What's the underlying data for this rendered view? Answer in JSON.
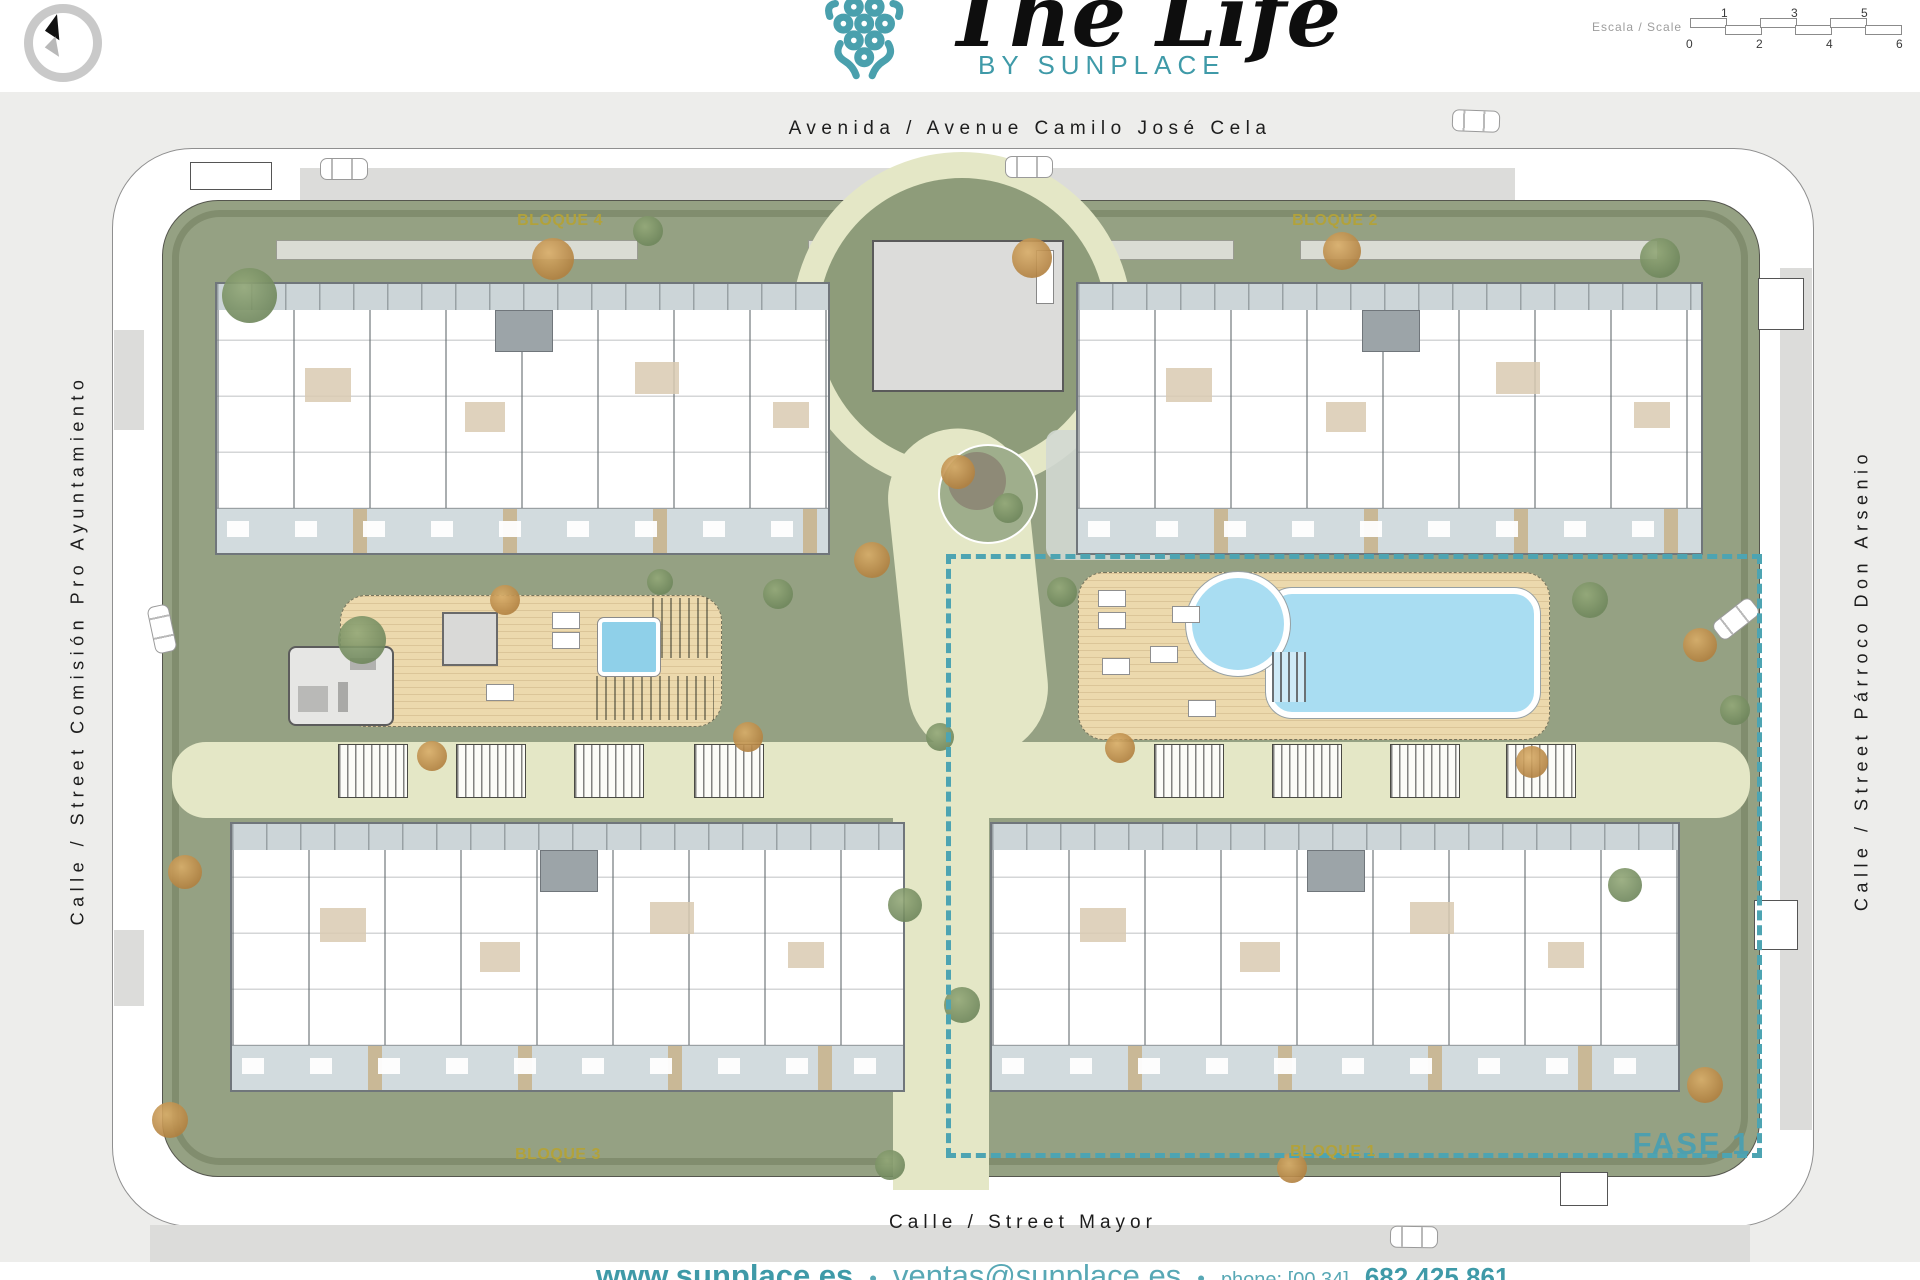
{
  "header": {
    "brand": {
      "title": "The Life",
      "subtitle": "BY SUNPLACE"
    },
    "scale": {
      "label": "Escala / Scale",
      "top_ticks": [
        "1",
        "3",
        "5"
      ],
      "bottom_ticks": [
        "0",
        "2",
        "4",
        "6"
      ]
    }
  },
  "streets": {
    "top": "Avenida / Avenue Camilo José Cela",
    "left": "Calle / Street Comisión Pro Ayuntamiento",
    "right": "Calle / Street Párroco Don Arsenio",
    "bottom": "Calle / Street Mayor"
  },
  "blocks": {
    "bloque4": "BLOQUE 4",
    "bloque2": "BLOQUE 2",
    "bloque3": "BLOQUE 3",
    "bloque1": "BLOQUE 1"
  },
  "phase": {
    "label": "FASE 1"
  },
  "footer": {
    "website": "www.sunplace.es",
    "bullet": "•",
    "email": "ventas@sunplace.es",
    "phone_label": "phone: [00 34]",
    "phone": "682 425 861"
  },
  "colors": {
    "teal": "#3f9aa8",
    "gold": "#b2a23b",
    "phase_dash": "#4da4b2",
    "pool_blue": "#a9ddf2",
    "deck_tan": "#ecd9ad",
    "grass_green": "#95a183",
    "path_cream": "#e4e7c6"
  }
}
